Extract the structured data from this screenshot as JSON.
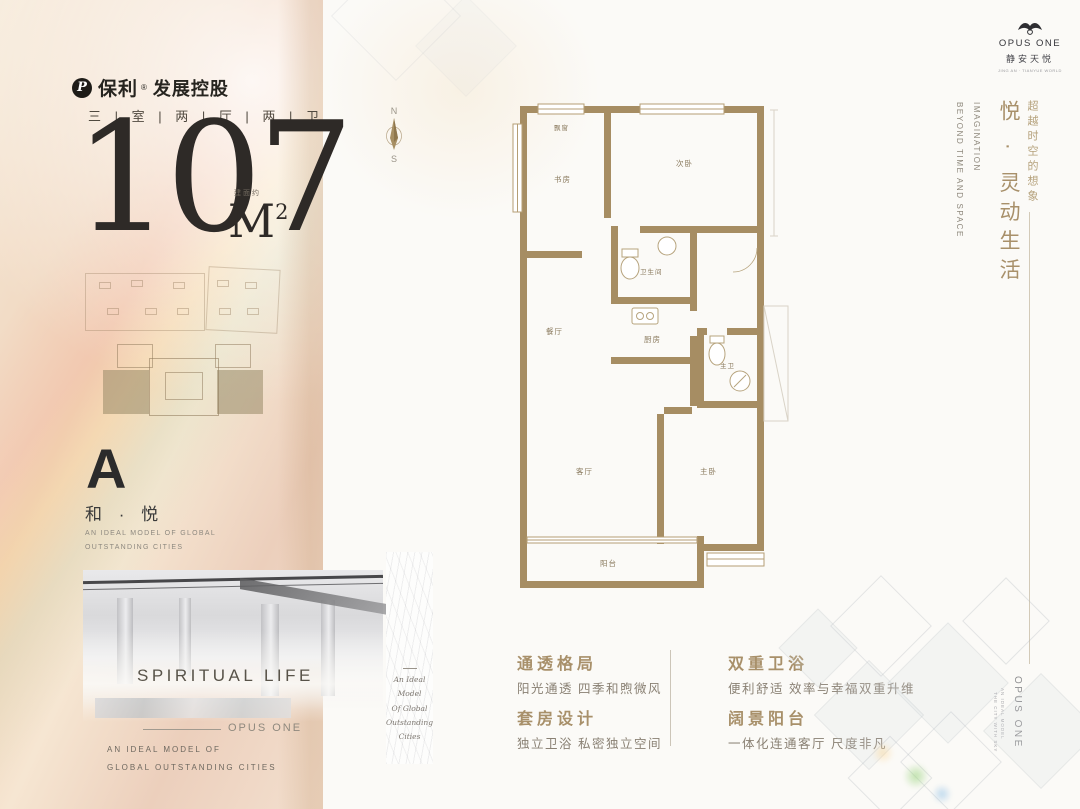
{
  "brand": {
    "poly_icon": "P",
    "poly_name": "保利",
    "poly_reg": "®",
    "poly_suffix": "发展控股"
  },
  "headline": {
    "rooms_line": "三 | 室 | 两 | 厅 | 两 | 卫",
    "area_number": "107",
    "area_note": "建面约",
    "area_unit": "M",
    "area_sup": "2"
  },
  "unit": {
    "letter": "A",
    "name": "和 · 悦",
    "tagline_line1": "AN IDEAL MODEL OF GLOBAL",
    "tagline_line2": "OUTSTANDING CITIES"
  },
  "photo": {
    "title": "SPIRITUAL LIFE",
    "rule_label": "OPUS ONE",
    "caption_line1": "AN IDEAL MODEL OF",
    "caption_line2": "GLOBAL OUTSTANDING CITIES"
  },
  "script_strip": {
    "line1": "An Ideal",
    "line2": "Model",
    "line3": "Of Global",
    "line4": "Outstanding",
    "line5": "Cities"
  },
  "compass": {
    "north": "N",
    "south": "S"
  },
  "floorplan": {
    "rooms": [
      {
        "label": "飘窗"
      },
      {
        "label": "书房"
      },
      {
        "label": "次卧"
      },
      {
        "label": "卫生间"
      },
      {
        "label": "厨房"
      },
      {
        "label": "餐厅"
      },
      {
        "label": "主卫"
      },
      {
        "label": "客厅"
      },
      {
        "label": "主卧"
      },
      {
        "label": "阳台"
      }
    ]
  },
  "opus_logo": {
    "name": "OPUS ONE",
    "cn": "静安天悦",
    "sub": "JING AN · TIANYUE WORLD"
  },
  "right_rail": {
    "cn_small": "超越时空的想象",
    "cn_big": "悦 · 灵动生活",
    "en_line1": "IMAGINATION",
    "en_line2": "BEYOND TIME AND SPACE",
    "bottom_brand": "OPUS ONE",
    "bottom_tiny1": "AN IDEAL MODEL",
    "bottom_tiny2": "THE CITY WITH SKY"
  },
  "features": {
    "left": [
      {
        "title": "通透格局",
        "desc": "阳光通透 四季和煦微风"
      },
      {
        "title": "套房设计",
        "desc": "独立卫浴 私密独立空间"
      }
    ],
    "right": [
      {
        "title": "双重卫浴",
        "desc": "便利舒适 效率与幸福双重升维"
      },
      {
        "title": "阔景阳台",
        "desc": "一体化连通客厅 尺度非凡"
      }
    ]
  },
  "colors": {
    "accent_gold": "#a8906a",
    "wall_tan": "#a68d63",
    "ink": "#2e2a27"
  }
}
